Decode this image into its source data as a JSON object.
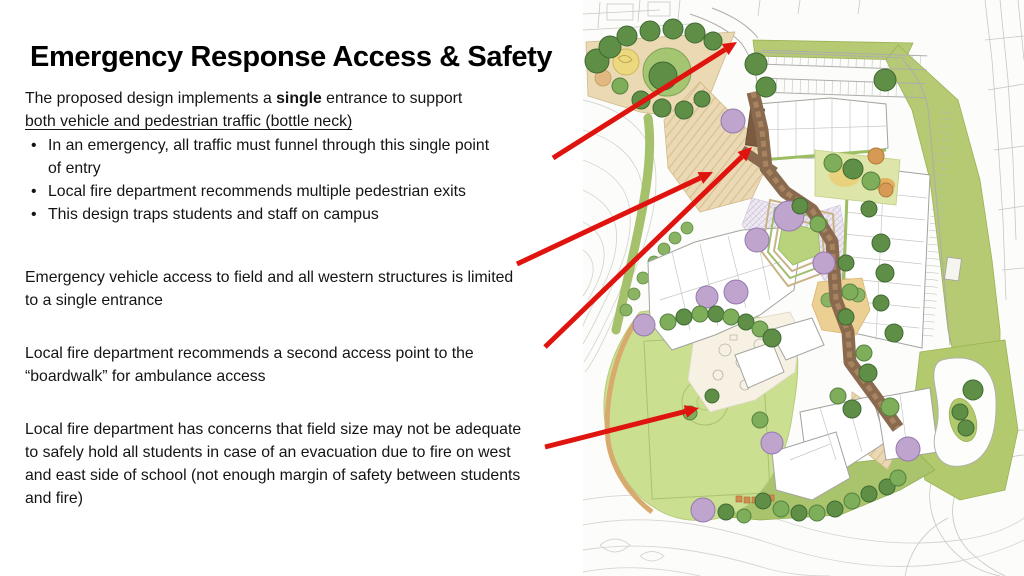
{
  "slide": {
    "title": "Emergency Response Access & Safety",
    "intro": {
      "text_before_bold": "The proposed design implements a ",
      "bold_word": "single",
      "text_after_bold": " entrance to support",
      "underlined_line": "both vehicle and pedestrian traffic (bottle neck)"
    },
    "bullets": [
      "In an emergency, all traffic must funnel through this single point of entry",
      "Local fire department recommends multiple pedestrian exits",
      "This design traps students and staff on campus"
    ],
    "paragraphs": [
      "Emergency vehicle access to field and all western structures is limited to a single entrance",
      "Local fire department recommends a second access point to the “boardwalk” for ambulance access",
      "Local fire department has concerns that field size may not be adequate to safely hold all students in case of an evacuation due to fire on west and east side of school (not enough margin of safety between students and fire)"
    ]
  },
  "annotations": {
    "color": "#e0140f",
    "arrows": [
      {
        "x1": 553,
        "y1": 158,
        "x2": 737,
        "y2": 42
      },
      {
        "x1": 517,
        "y1": 264,
        "x2": 713,
        "y2": 172
      },
      {
        "x1": 545,
        "y1": 347,
        "x2": 752,
        "y2": 147
      },
      {
        "x1": 545,
        "y1": 447,
        "x2": 699,
        "y2": 408
      }
    ]
  },
  "map_palette": {
    "field_green": "#cadf90",
    "buffer_green": "#b5ca72",
    "tree_green": "#5f8f47",
    "boardwalk_brown": "#8a6a4e",
    "plaza_tan": "#ead9b4"
  }
}
